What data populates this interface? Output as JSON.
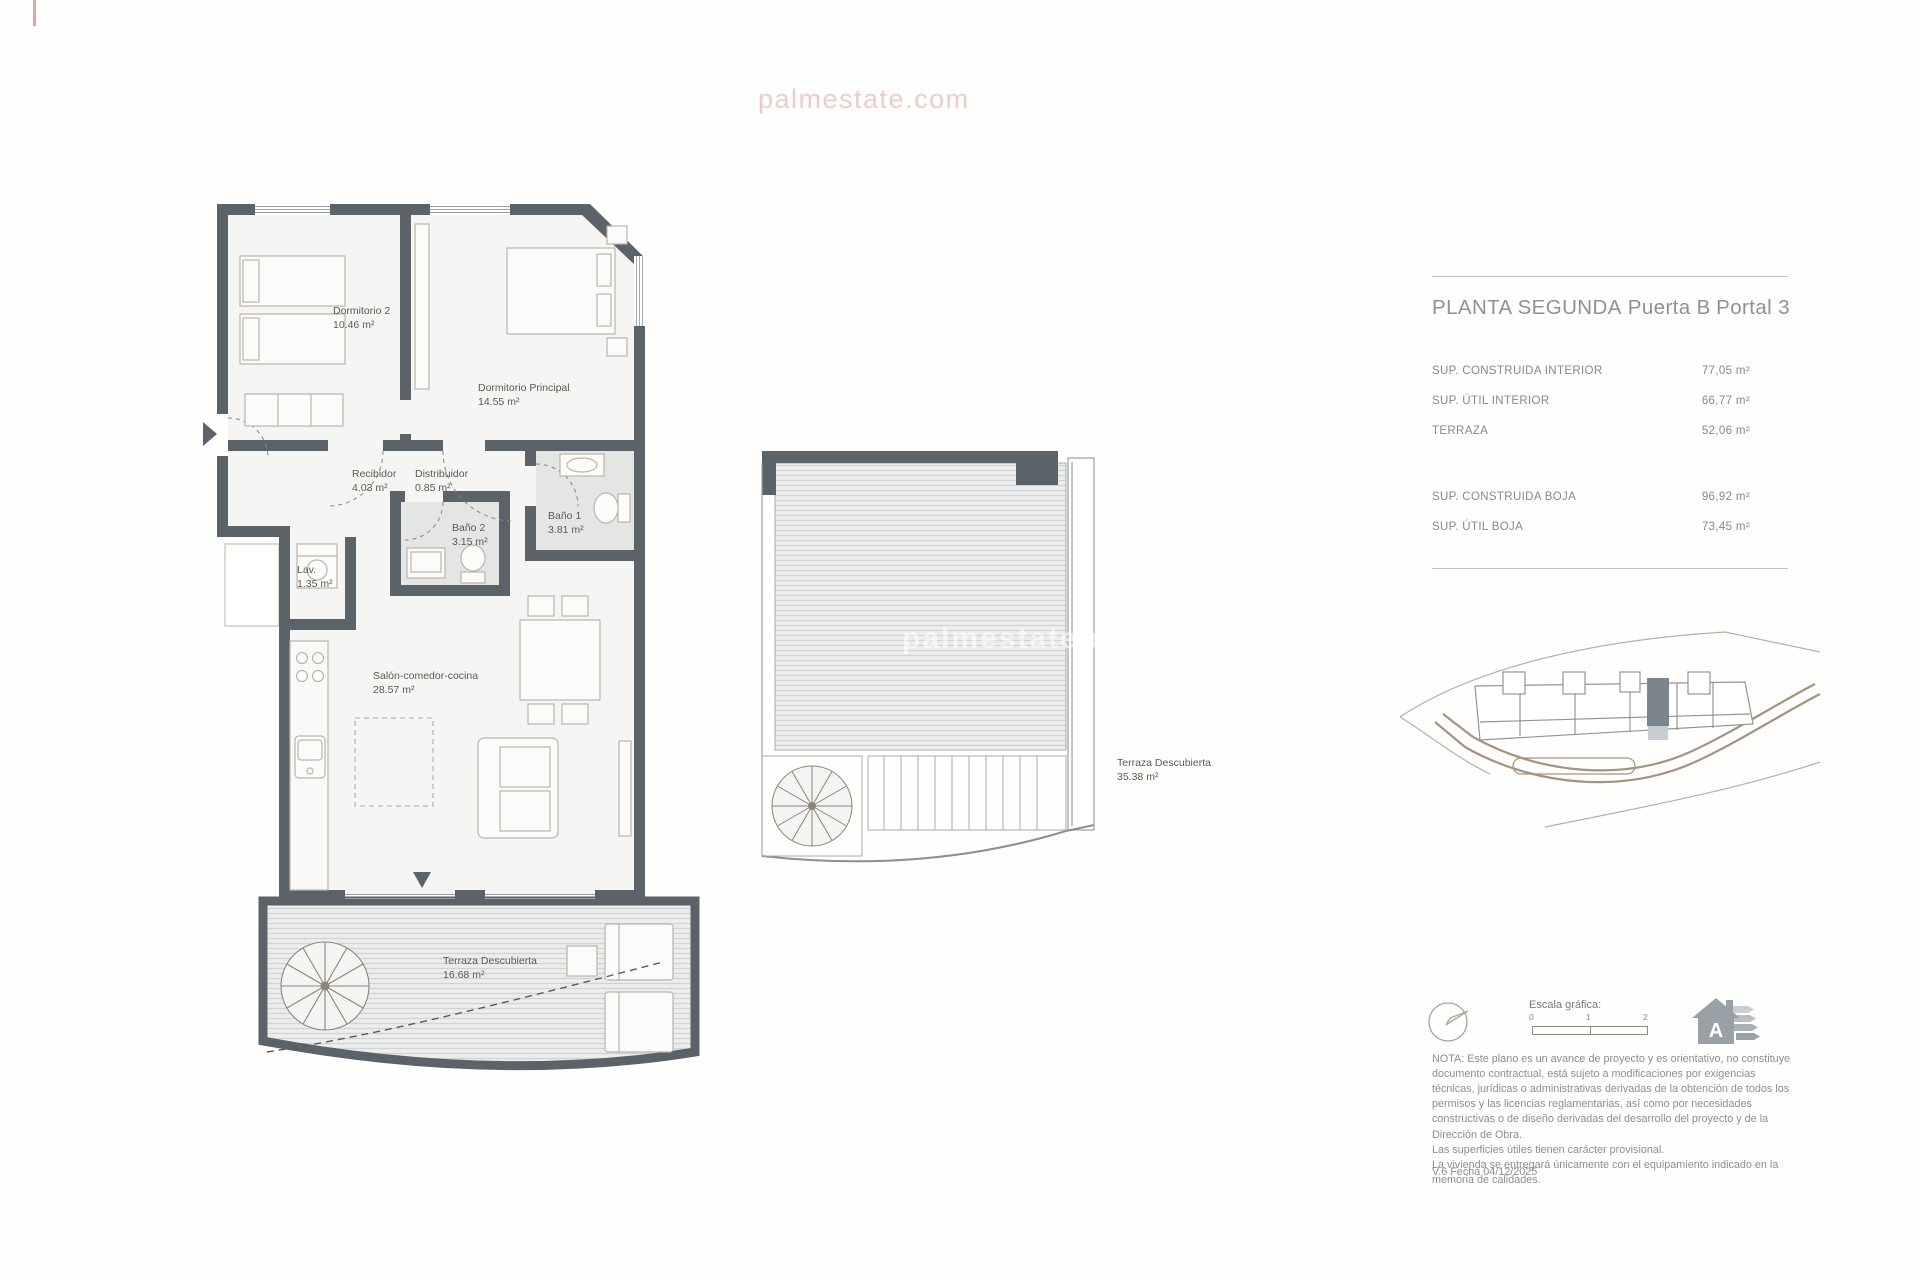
{
  "watermark": {
    "top": "palmestate.com",
    "middle": "palmestate.com"
  },
  "title": {
    "main": "PLANTA SEGUNDA",
    "puerta": "Puerta B",
    "portal": "Portal 3"
  },
  "areas": {
    "rows": [
      {
        "label": "SUP. CONSTRUIDA INTERIOR",
        "value": "77,05 m²"
      },
      {
        "label": "SUP. ÚTIL INTERIOR",
        "value": "66,77 m²"
      },
      {
        "label": "TERRAZA",
        "value": "52,06 m²"
      }
    ],
    "rows_boja": [
      {
        "label": "SUP. CONSTRUIDA BOJA",
        "value": "96,92 m²"
      },
      {
        "label": "SUP. ÚTIL BOJA",
        "value": "73,45 m²"
      }
    ]
  },
  "plan": {
    "rooms": [
      {
        "name": "Dormitorio 2",
        "area": "10.46 m²"
      },
      {
        "name": "Dormitorio Principal",
        "area": "14.55 m²"
      },
      {
        "name": "Recibidor",
        "area": "4.03 m²"
      },
      {
        "name": "Distribuidor",
        "area": "0.85 m²"
      },
      {
        "name": "Baño 2",
        "area": "3.15 m²"
      },
      {
        "name": "Baño 1",
        "area": "3.81 m²"
      },
      {
        "name": "Lav.",
        "area": "1.35 m²"
      },
      {
        "name": "Salón-comedor-cocina",
        "area": "28.57 m²"
      },
      {
        "name": "Terraza Descubierta",
        "area": "16.68 m²"
      }
    ],
    "upper_terrace": {
      "name": "Terraza Descubierta",
      "area": "35.38 m²"
    }
  },
  "legend": {
    "scale_label": "Escala gráfica:",
    "scale_ticks": [
      "0",
      "1",
      "2"
    ],
    "energy_letter": "A"
  },
  "notes": {
    "nota": "NOTA: Este plano es un avance de proyecto y es orientativo, no constituye documento contractual, está sujeto a modificaciones por exigencias técnicas, jurídicas o administrativas derivadas de la obtención de todos los permisos y las licencias reglamentarias, así como por necesidades constructivas o de diseño derivadas del desarrollo del proyecto y de la Dirección de Obra.\nLas superficies útiles tienen carácter provisional.\nLa vivienda se entregará únicamente con el equipamiento indicado en la memoria de calidades.",
    "version": "V.6 Fecha 04/12/2025"
  },
  "colors": {
    "wall": "#5b6369",
    "furniture_line": "#bcb4aa",
    "accent_red": "#c64b46",
    "highlight_unit": "#7b858d"
  }
}
